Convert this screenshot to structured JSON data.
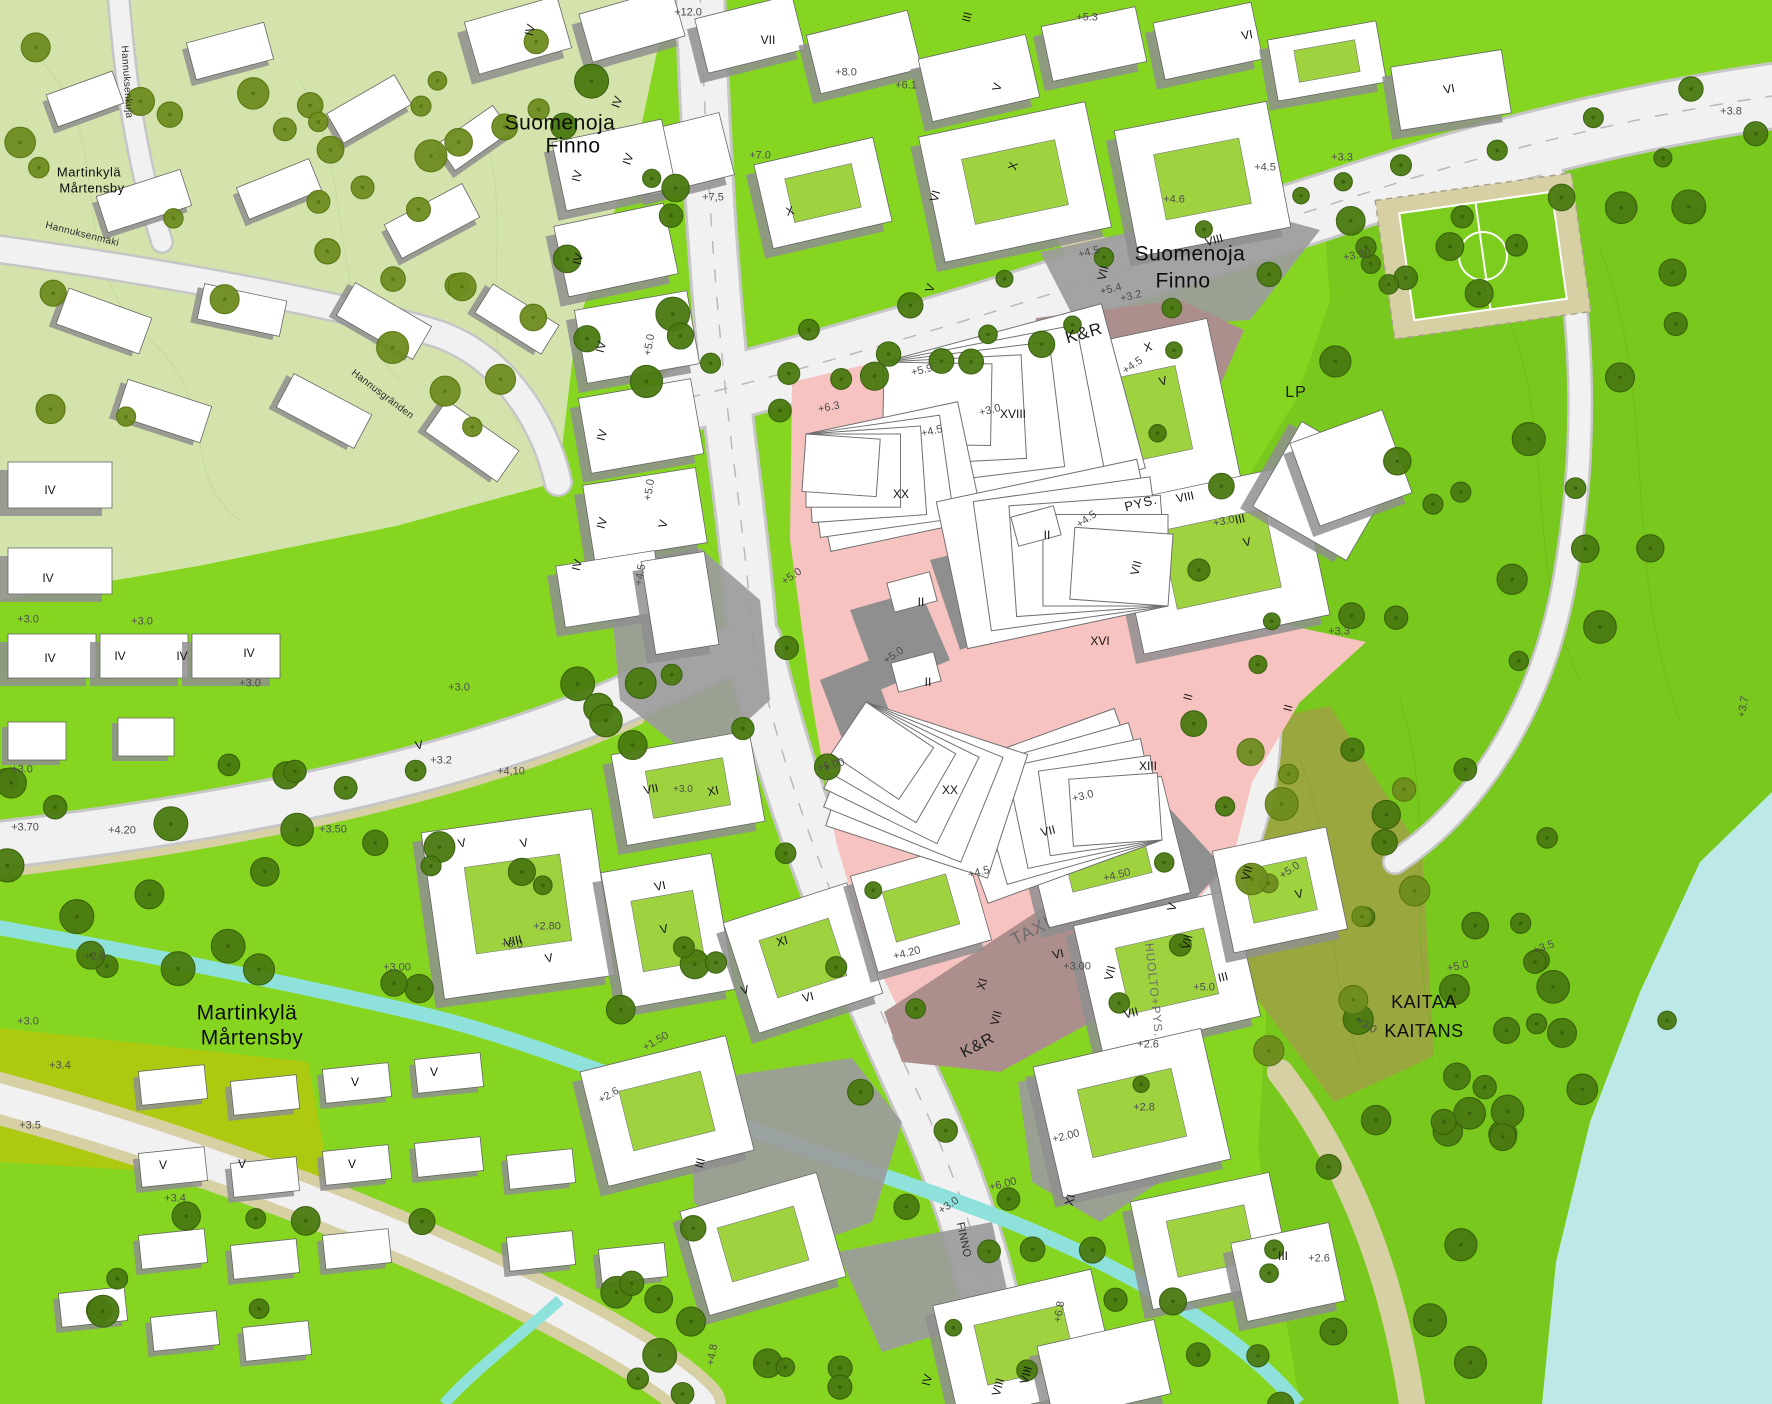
{
  "map": {
    "colors": {
      "pale_green": "#d4e3ab",
      "bright_green": "#86d621",
      "forest_green": "#79c81e",
      "olive_green": "#9aa63e",
      "khaki_field": "#adca10",
      "tree_dark": "#4a7a10",
      "tree_olive": "#6e8d1f",
      "road": "#f1f1f1",
      "road_casing": "#c6c6c6",
      "surface_gray": "#9c9c9c",
      "shadow_gray": "#8f8f8f",
      "plaza_pink": "#f7c3c0",
      "deck_mauve": "#ac8f8d",
      "stream_teal": "#8fe2dc",
      "lake_blue": "#bde8e8",
      "path_tan": "#d7d0a5",
      "building_white": "#ffffff",
      "courtyard_green": "#9ed33f"
    },
    "place_labels": [
      {
        "t": "Martinkylä",
        "x": 89,
        "y": 172,
        "s": 13,
        "r": 0
      },
      {
        "t": "Mårtensby",
        "x": 92,
        "y": 188,
        "s": 13,
        "r": 0
      },
      {
        "t": "Suomenoja",
        "x": 560,
        "y": 123,
        "s": 21,
        "r": 0
      },
      {
        "t": "Finno",
        "x": 573,
        "y": 146,
        "s": 21,
        "r": 0
      },
      {
        "t": "Suomenoja",
        "x": 1190,
        "y": 254,
        "s": 21,
        "r": 0
      },
      {
        "t": "Finno",
        "x": 1183,
        "y": 281,
        "s": 21,
        "r": 0
      },
      {
        "t": "Martinkylä",
        "x": 247,
        "y": 1013,
        "s": 21,
        "r": 0
      },
      {
        "t": "Mårtensby",
        "x": 252,
        "y": 1038,
        "s": 21,
        "r": 0
      },
      {
        "t": "KAITAA",
        "x": 1424,
        "y": 1002,
        "s": 18,
        "r": 0
      },
      {
        "t": "KAITANS",
        "x": 1424,
        "y": 1031,
        "s": 18,
        "r": 0
      }
    ],
    "road_labels": [
      {
        "t": "Hannuksenkuja",
        "x": 126,
        "y": 82,
        "s": 10,
        "r": 86
      },
      {
        "t": "Hannuksenmäki",
        "x": 82,
        "y": 235,
        "s": 10,
        "r": 14
      },
      {
        "t": "Hannusgränden",
        "x": 382,
        "y": 395,
        "s": 10,
        "r": 37
      },
      {
        "t": "FINNO",
        "x": 963,
        "y": 1240,
        "s": 11,
        "r": 78
      }
    ],
    "zone_labels": [
      {
        "t": "K&R",
        "x": 1084,
        "y": 333,
        "s": 17,
        "r": -16
      },
      {
        "t": "LP",
        "x": 1296,
        "y": 393,
        "s": 16,
        "r": 0
      },
      {
        "t": "PYS.",
        "x": 1141,
        "y": 503,
        "s": 13,
        "r": -14
      },
      {
        "t": "TAXI",
        "x": 1031,
        "y": 931,
        "s": 18,
        "r": -27,
        "tone": "gray"
      },
      {
        "t": "HUOLTO+PYS.",
        "x": 1154,
        "y": 990,
        "s": 12,
        "r": 84,
        "tone": "gray"
      },
      {
        "t": "K&R",
        "x": 978,
        "y": 1046,
        "s": 16,
        "r": -28
      }
    ],
    "elevation_labels": [
      {
        "t": "+12.0",
        "x": 688,
        "y": 13,
        "r": 0
      },
      {
        "t": "+5.3",
        "x": 1087,
        "y": 18,
        "r": 0
      },
      {
        "t": "+8.0",
        "x": 846,
        "y": 73,
        "r": 0
      },
      {
        "t": "+6.1",
        "x": 906,
        "y": 86,
        "r": 0
      },
      {
        "t": "+7.0",
        "x": 760,
        "y": 156,
        "r": 0
      },
      {
        "t": "+7,5",
        "x": 713,
        "y": 198,
        "r": 0
      },
      {
        "t": "+3.3",
        "x": 1342,
        "y": 158,
        "r": 0
      },
      {
        "t": "+4.6",
        "x": 1174,
        "y": 200,
        "r": 0
      },
      {
        "t": "+4.5",
        "x": 1265,
        "y": 168,
        "r": 0
      },
      {
        "t": "+3.8",
        "x": 1731,
        "y": 112,
        "r": 0
      },
      {
        "t": "+3.30",
        "x": 1357,
        "y": 256,
        "r": -10
      },
      {
        "t": "+5.4",
        "x": 1111,
        "y": 290,
        "r": -14
      },
      {
        "t": "+4.5",
        "x": 1089,
        "y": 253,
        "r": -14
      },
      {
        "t": "+3.2",
        "x": 1131,
        "y": 297,
        "r": -14
      },
      {
        "t": "+5.9",
        "x": 922,
        "y": 371,
        "r": -14
      },
      {
        "t": "+6.3",
        "x": 829,
        "y": 408,
        "r": -12
      },
      {
        "t": "+4.5",
        "x": 932,
        "y": 432,
        "r": -14
      },
      {
        "t": "+4.5",
        "x": 1133,
        "y": 366,
        "r": -35
      },
      {
        "t": "+3.0",
        "x": 990,
        "y": 411,
        "r": -14
      },
      {
        "t": "+4.5",
        "x": 1087,
        "y": 520,
        "r": -35
      },
      {
        "t": "+5.0",
        "x": 650,
        "y": 345,
        "r": -80
      },
      {
        "t": "+5.0",
        "x": 650,
        "y": 490,
        "r": -80
      },
      {
        "t": "+4.5",
        "x": 641,
        "y": 575,
        "r": -80
      },
      {
        "t": "+5.0",
        "x": 792,
        "y": 577,
        "r": -35
      },
      {
        "t": "+5.0",
        "x": 894,
        "y": 656,
        "r": -35
      },
      {
        "t": "+5.00",
        "x": 831,
        "y": 766,
        "r": -14
      },
      {
        "t": "+3.0",
        "x": 1083,
        "y": 797,
        "r": -14
      },
      {
        "t": "+4.5",
        "x": 979,
        "y": 873,
        "r": -14
      },
      {
        "t": "+4.50",
        "x": 1117,
        "y": 876,
        "r": -14
      },
      {
        "t": "+4.20",
        "x": 907,
        "y": 954,
        "r": -14
      },
      {
        "t": "+4,10",
        "x": 511,
        "y": 772,
        "r": 0
      },
      {
        "t": "+3.2",
        "x": 441,
        "y": 761,
        "r": 0
      },
      {
        "t": "+3.50",
        "x": 333,
        "y": 830,
        "r": 0
      },
      {
        "t": "+4.20",
        "x": 122,
        "y": 831,
        "r": 0
      },
      {
        "t": "+3.70",
        "x": 25,
        "y": 828,
        "r": 0
      },
      {
        "t": "+3.0",
        "x": 28,
        "y": 620,
        "r": 0
      },
      {
        "t": "+3.0",
        "x": 142,
        "y": 622,
        "r": 0
      },
      {
        "t": "+3.0",
        "x": 250,
        "y": 684,
        "r": 0
      },
      {
        "t": "+3.0",
        "x": 22,
        "y": 770,
        "r": 0
      },
      {
        "t": "+3.0",
        "x": 459,
        "y": 688,
        "r": 0
      },
      {
        "t": "+2.6",
        "x": 95,
        "y": 957,
        "r": 0
      },
      {
        "t": "+3.0",
        "x": 28,
        "y": 1022,
        "r": 0
      },
      {
        "t": "+3.4",
        "x": 60,
        "y": 1066,
        "r": 0
      },
      {
        "t": "+3.5",
        "x": 30,
        "y": 1126,
        "r": 0
      },
      {
        "t": "+3.4",
        "x": 175,
        "y": 1199,
        "r": 0
      },
      {
        "t": "+3.00",
        "x": 397,
        "y": 968,
        "r": 0
      },
      {
        "t": "+2.80",
        "x": 547,
        "y": 927,
        "r": 0
      },
      {
        "t": "+3.0",
        "x": 512,
        "y": 945,
        "r": 0
      },
      {
        "t": "+3.0",
        "x": 683,
        "y": 790,
        "s": 10,
        "r": 0
      },
      {
        "t": "+3.00",
        "x": 1077,
        "y": 967,
        "r": 0
      },
      {
        "t": "+5.0",
        "x": 1204,
        "y": 988,
        "r": 0
      },
      {
        "t": "+2.6",
        "x": 1148,
        "y": 1045,
        "r": 0
      },
      {
        "t": "+2.8",
        "x": 1144,
        "y": 1108,
        "r": 0
      },
      {
        "t": "+2.00",
        "x": 1066,
        "y": 1137,
        "r": -14
      },
      {
        "t": "+6.00",
        "x": 1003,
        "y": 1185,
        "r": -14
      },
      {
        "t": "+3.0",
        "x": 949,
        "y": 1206,
        "r": -35
      },
      {
        "t": "+1.50",
        "x": 656,
        "y": 1042,
        "r": -30
      },
      {
        "t": "+2.6",
        "x": 609,
        "y": 1096,
        "r": -30
      },
      {
        "t": "+4.8",
        "x": 713,
        "y": 1355,
        "r": -80
      },
      {
        "t": "+6.8",
        "x": 1060,
        "y": 1312,
        "r": -80
      },
      {
        "t": "+5.0",
        "x": 1290,
        "y": 871,
        "r": -35
      },
      {
        "t": "+5.0",
        "x": 1458,
        "y": 967,
        "r": -12
      },
      {
        "t": "+3.0",
        "x": 1366,
        "y": 1026,
        "r": 30
      },
      {
        "t": "+3.5",
        "x": 1544,
        "y": 948,
        "r": -20
      },
      {
        "t": "+3.7",
        "x": 1744,
        "y": 707,
        "r": -80
      },
      {
        "t": "+2.6",
        "x": 1319,
        "y": 1259,
        "r": 0
      },
      {
        "t": "+3.3",
        "x": 1339,
        "y": 632,
        "r": 0
      },
      {
        "t": "+3.0",
        "x": 1224,
        "y": 522,
        "r": -12
      }
    ],
    "storey_labels": [
      {
        "t": "IV",
        "x": 530,
        "y": 30,
        "r": -75
      },
      {
        "t": "VII",
        "x": 768,
        "y": 40,
        "r": 0
      },
      {
        "t": "III",
        "x": 967,
        "y": 17,
        "r": -75
      },
      {
        "t": "VI",
        "x": 1247,
        "y": 35,
        "r": -10
      },
      {
        "t": "VI",
        "x": 1449,
        "y": 89,
        "r": -10
      },
      {
        "t": "V",
        "x": 997,
        "y": 87,
        "r": -75
      },
      {
        "t": "IV",
        "x": 617,
        "y": 102,
        "r": -70
      },
      {
        "t": "IV",
        "x": 628,
        "y": 159,
        "r": -70
      },
      {
        "t": "X",
        "x": 790,
        "y": 211,
        "r": -15
      },
      {
        "t": "VI",
        "x": 935,
        "y": 196,
        "r": -75
      },
      {
        "t": "X",
        "x": 1013,
        "y": 166,
        "r": -75
      },
      {
        "t": "VII",
        "x": 1103,
        "y": 273,
        "r": -75
      },
      {
        "t": "VIII",
        "x": 1214,
        "y": 240,
        "r": -15
      },
      {
        "t": "V",
        "x": 930,
        "y": 288,
        "r": -70
      },
      {
        "t": "X",
        "x": 1148,
        "y": 347,
        "r": -15
      },
      {
        "t": "V",
        "x": 1163,
        "y": 381,
        "r": -15
      },
      {
        "t": "XVIII",
        "x": 1013,
        "y": 414,
        "r": 0
      },
      {
        "t": "XX",
        "x": 901,
        "y": 494,
        "r": 0
      },
      {
        "t": "II",
        "x": 921,
        "y": 602,
        "r": 0
      },
      {
        "t": "II",
        "x": 1047,
        "y": 535,
        "r": 0
      },
      {
        "t": "II",
        "x": 928,
        "y": 682,
        "r": 0
      },
      {
        "t": "XVI",
        "x": 1100,
        "y": 641,
        "r": 0
      },
      {
        "t": "XIII",
        "x": 1148,
        "y": 766,
        "r": 0
      },
      {
        "t": "XX",
        "x": 950,
        "y": 790,
        "r": 0
      },
      {
        "t": "II",
        "x": 1188,
        "y": 697,
        "r": -75
      },
      {
        "t": "II",
        "x": 1288,
        "y": 708,
        "r": -75
      },
      {
        "t": "VIII",
        "x": 1185,
        "y": 497,
        "r": -12
      },
      {
        "t": "III",
        "x": 1240,
        "y": 519,
        "r": -12
      },
      {
        "t": "V",
        "x": 1247,
        "y": 542,
        "r": -12
      },
      {
        "t": "VII",
        "x": 1136,
        "y": 568,
        "r": -75
      },
      {
        "t": "IV",
        "x": 577,
        "y": 176,
        "r": -75
      },
      {
        "t": "IV",
        "x": 578,
        "y": 259,
        "r": -75
      },
      {
        "t": "IV",
        "x": 601,
        "y": 347,
        "r": -75
      },
      {
        "t": "IV",
        "x": 602,
        "y": 435,
        "r": -75
      },
      {
        "t": "IV",
        "x": 602,
        "y": 523,
        "r": -75
      },
      {
        "t": "IV",
        "x": 577,
        "y": 565,
        "r": -75
      },
      {
        "t": "V",
        "x": 663,
        "y": 524,
        "r": -75
      },
      {
        "t": "IV",
        "x": 50,
        "y": 490,
        "r": 0
      },
      {
        "t": "IV",
        "x": 48,
        "y": 578,
        "r": 0
      },
      {
        "t": "IV",
        "x": 50,
        "y": 658,
        "r": 0
      },
      {
        "t": "IV",
        "x": 120,
        "y": 656,
        "r": 0
      },
      {
        "t": "IV",
        "x": 182,
        "y": 656,
        "r": 0
      },
      {
        "t": "IV",
        "x": 249,
        "y": 653,
        "r": 0
      },
      {
        "t": "V",
        "x": 419,
        "y": 745,
        "r": -10
      },
      {
        "t": "VII",
        "x": 651,
        "y": 789,
        "r": -12
      },
      {
        "t": "XI",
        "x": 713,
        "y": 791,
        "r": -12
      },
      {
        "t": "V",
        "x": 462,
        "y": 843,
        "r": -12
      },
      {
        "t": "V",
        "x": 524,
        "y": 843,
        "r": -12
      },
      {
        "t": "VIII",
        "x": 513,
        "y": 941,
        "r": -12
      },
      {
        "t": "V",
        "x": 549,
        "y": 958,
        "r": -12
      },
      {
        "t": "VI",
        "x": 660,
        "y": 886,
        "r": -12
      },
      {
        "t": "V",
        "x": 664,
        "y": 929,
        "r": -12
      },
      {
        "t": "XI",
        "x": 782,
        "y": 941,
        "r": -15
      },
      {
        "t": "VI",
        "x": 808,
        "y": 997,
        "r": -15
      },
      {
        "t": "V",
        "x": 745,
        "y": 990,
        "r": -15
      },
      {
        "t": "VII",
        "x": 1048,
        "y": 831,
        "r": -14
      },
      {
        "t": "VI",
        "x": 1058,
        "y": 954,
        "r": -14
      },
      {
        "t": "XI",
        "x": 982,
        "y": 984,
        "r": -75
      },
      {
        "t": "VII",
        "x": 996,
        "y": 1018,
        "r": -75
      },
      {
        "t": "V",
        "x": 1172,
        "y": 907,
        "r": -75
      },
      {
        "t": "VII",
        "x": 1110,
        "y": 973,
        "r": -75
      },
      {
        "t": "VII",
        "x": 1187,
        "y": 942,
        "r": -75
      },
      {
        "t": "VII",
        "x": 1247,
        "y": 873,
        "r": -75
      },
      {
        "t": "V",
        "x": 1299,
        "y": 894,
        "r": -12
      },
      {
        "t": "VII",
        "x": 1131,
        "y": 1013,
        "r": -14
      },
      {
        "t": "III",
        "x": 1223,
        "y": 977,
        "r": -14
      },
      {
        "t": "III",
        "x": 1283,
        "y": 1256,
        "r": 0
      },
      {
        "t": "V",
        "x": 355,
        "y": 1082,
        "r": 0
      },
      {
        "t": "V",
        "x": 434,
        "y": 1072,
        "r": 0
      },
      {
        "t": "V",
        "x": 163,
        "y": 1165,
        "r": 0
      },
      {
        "t": "V",
        "x": 242,
        "y": 1164,
        "r": 0
      },
      {
        "t": "V",
        "x": 352,
        "y": 1164,
        "r": 0
      },
      {
        "t": "III",
        "x": 700,
        "y": 1163,
        "r": -75
      },
      {
        "t": "IV",
        "x": 927,
        "y": 1380,
        "r": -75
      },
      {
        "t": "VIII",
        "x": 998,
        "y": 1387,
        "r": -75
      },
      {
        "t": "VIII",
        "x": 1026,
        "y": 1375,
        "r": -75
      },
      {
        "t": "XI",
        "x": 1070,
        "y": 1200,
        "r": -75
      }
    ]
  }
}
